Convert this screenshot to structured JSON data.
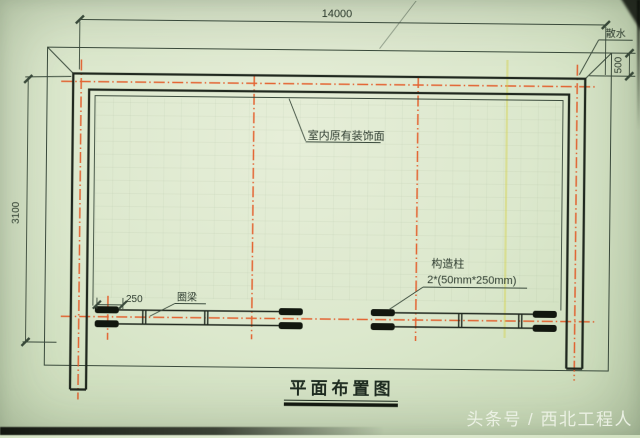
{
  "drawing": {
    "title": "平面布置图",
    "dim_overall_width": "14000",
    "dim_left_height": "3100",
    "dim_apron_width": "500",
    "dim_column_length": "250",
    "label_apron": "散水",
    "label_interior_finish": "室内原有装饰面",
    "label_ring_beam": "圈梁",
    "label_column_title": "构造柱",
    "label_column_spec": "2*(50mm*250mm)"
  },
  "photo": {
    "watermark": "头条号 / 西北工程人"
  },
  "colors": {
    "paper": "#dce8cd",
    "ink": "#2c3a2e",
    "wall": "#20281f",
    "centerline_orange": "#e45a26",
    "highlight_yellow": "#d6d24e",
    "watermark_white": "#eef3e7"
  }
}
